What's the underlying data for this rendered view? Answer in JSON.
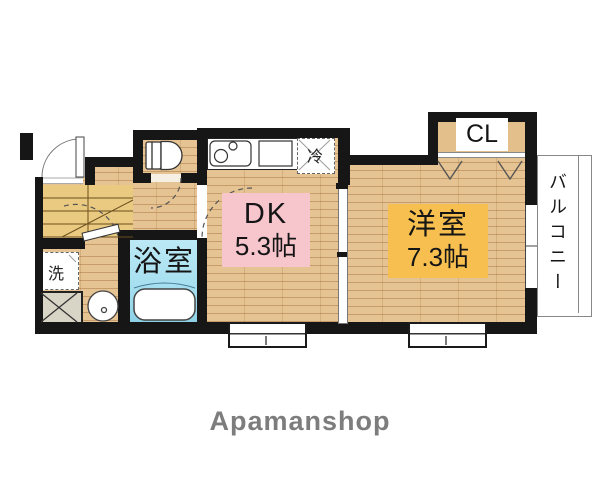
{
  "floorplan": {
    "rooms": {
      "dining_kitchen": {
        "name": "DK",
        "area": "5.3帖"
      },
      "western_room": {
        "name": "洋室",
        "area": "7.3帖"
      },
      "bathroom": {
        "name": "浴室"
      },
      "closet": {
        "name": "CL"
      },
      "balcony": {
        "name": "バルコニー"
      }
    },
    "fixtures": {
      "refrigerator": "冷",
      "washing_machine": "洗"
    }
  },
  "branding": {
    "logo": "Apamanshop"
  },
  "colors": {
    "wall": "#161616",
    "wood_floor": "#E6C392",
    "bathroom_fill": "#A7E0F0",
    "dk_label_bg": "#F7C5CC",
    "western_label_bg": "#F6BF4F",
    "stairs_fill": "#E9CA80",
    "logo_gray": "#7D7D7D"
  }
}
